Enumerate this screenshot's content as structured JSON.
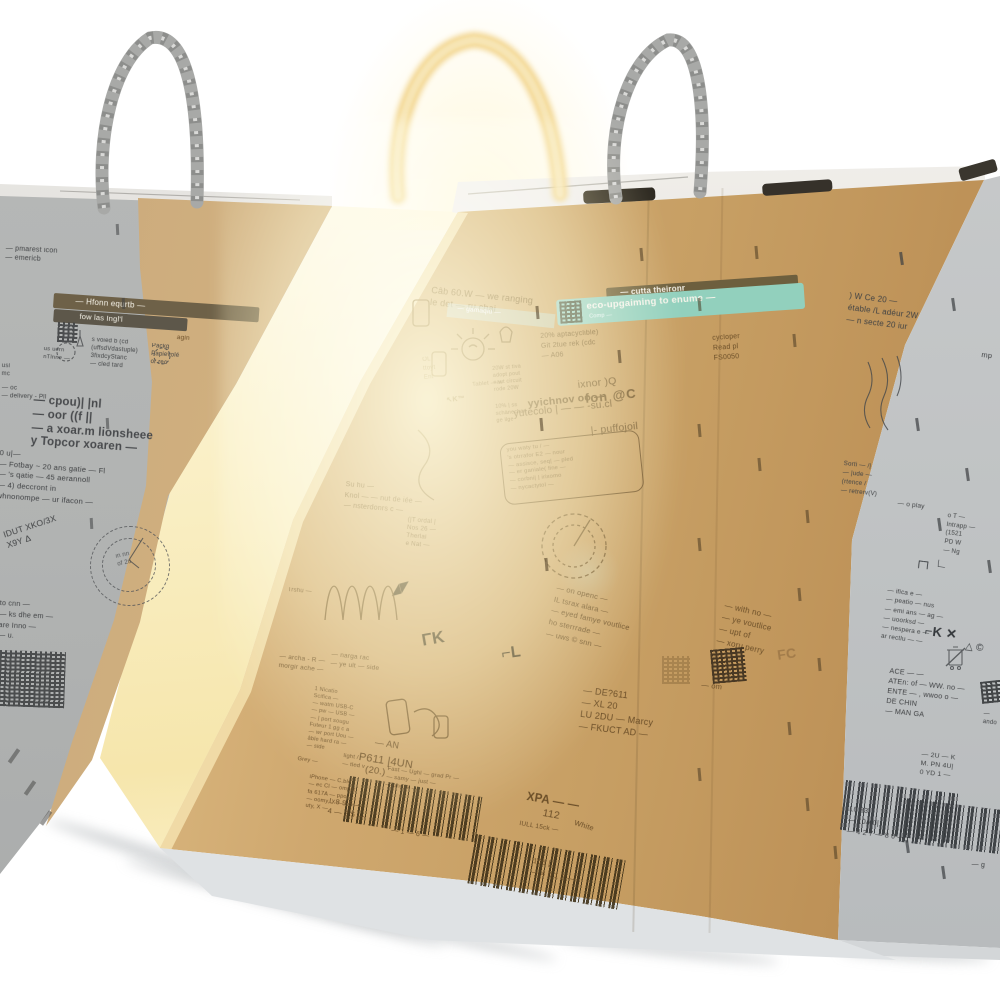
{
  "colors": {
    "kraft_lit": "#cfa86f",
    "kraft_bright": "#ecd6a4",
    "kraft_dark": "#b78a50",
    "shadow_grey": "#b5b7b6",
    "side_grey": "#c0c3c4",
    "print_brown": "#6b4e28",
    "print_grey": "#3f4143",
    "teal_banner": "#92d0bd",
    "olive_banner": "#6d5f3e",
    "glow_yellow": "#f6e6ac",
    "handle_grey": "#a6a7a5",
    "handle_glow": "#f2d48c",
    "slot_dark": "#2d2921"
  },
  "icons": {
    "qr": "qr-code-pattern",
    "barcode": "ean-barcode",
    "weee": "weee-bin-icon",
    "conformity": "ce-conformity-glyphs",
    "bulb": "lamp-doodle",
    "phone": "smartphone-doodle",
    "spring": "coil-doodle",
    "stamp": "round-certification-stamp",
    "handle": "twisted-paper-handle"
  },
  "left_box": {
    "top_fragments": "— pmarest icon\n— emericb",
    "banner_line1": "—  Hfonn  equrtb —",
    "banner_line2": "fow las Ingl'l",
    "side_small": "us uern\nnTlnne —",
    "recycle_row": "s voied b (cd\n(uffsdVdastuple)\n3fixdcyStanc\n— cled tard",
    "recycle_row2": "Packg\nPapievolé\nor rec",
    "recycle_row3": "agin",
    "edge_fragment": "usl\nmc",
    "port_small": "— oc\n— delivery - Pll",
    "brand_block": "— cpou)| |nl\n— oor  ((f  ||\n— a xoar.m lionsheee\ny Topcor xoaren —",
    "warranty_block": "0 u|—\n— Fotbay ~ 20 ans gatie — Fl\n— 's qatie — 45 aerannoll\n— 4) deccront in\nwhnonompe — ur ifacon —",
    "stamp_vertical": "IDUT XKO/3X\nX9Y Δ",
    "stamp_inner": "in nn\nof 2u",
    "lower_fragments": "to cnn —\n— ks dhe em —\nare Inno —\n— u."
  },
  "front_box": {
    "top_note": "Câb 60.W — we ranging\nle det — ru chai",
    "eco_banner_pale": "— gamaqiu —",
    "eco_banner_dark": "— cutta theironr",
    "eco_banner_teal": "eco-upgaiming to enume —",
    "eco_banner_sub": "Comp —",
    "recycle_text": "20% aptacyclible)\nGit 2tue rek (cdc\n— A06",
    "recycle_text2": "cycloper\nRead pl\nFS0050",
    "badge_20w": "20W st tiva\nadopt pout\nnaut circuit\nrode 20W",
    "tablet_label": "Tablet — w",
    "km_label": "↖K™",
    "left_icons_label": "OL\nttoyt\nEnt",
    "schar_label": "10% | ss\nschänechar\nge   ilge",
    "brand_l1": "ixnor )Q",
    "brand_l2": "fon @C",
    "brand_l3": "yyichnov oo —",
    "brand_l4": "yutecolo | — — -su.cl",
    "brand_l5": "|- puffojoil",
    "warranty_block": "you waty tu / —\n's otrrafor E2 — nour\n— assisce, seq| — pled\n— er ganiale( fine —\n— corbni| | irixomo\n— nycactytol —",
    "mid_fragments": "Su hu —\nKnol — — nut de iée —\n— nsterdonrs c —",
    "stamp_text": "(|T ordal |\nNos 26 —\nTherlai\ne Nat —",
    "trshu_label": "Trshu —",
    "glyphs1": "◢◤",
    "glyphs2": "ΓK",
    "glyphs3": "⌐L",
    "right_tilt_block": "— on openc —\nIL tsrax alara —\n— eyed famye voutlice\nho sterrrade —\n— uws © snn —",
    "right_tilt_block2": "— with no —\n— ye voutlice\n— upt of\n— xoru perry",
    "fcc_ghost": "FC",
    "code_block": "— DE?611\n— XL 20\nLU 2DU — Marcy\n— FKUCT AD —",
    "code_om": "— om",
    "specs_block": "1 Nicatio\nScifica —\n— watm USB-C\n— pw — USB —\n— | port sougu\nFuteur 1 gg c a\n— wr port Uou —\nâble hard ra —\n— side",
    "light_label": "light /\n— tled v",
    "fast_block": "Fast — Ughl — grad Pr —\n— samy — just —\n— ung, k —",
    "marga_block": "— narga rac\n— ye ult — side",
    "archa_block": "— archa - R —\nmorgir ache —",
    "ean_label": "— AN",
    "code_p611": "P611 |4UN",
    "code_20": "(20.)",
    "barcode1_left": "L 8 9 5 —\n4 — 2 5 —",
    "barcode1_digits": "— 1 — 6 —",
    "xpa_label": "XPA — —",
    "num_112": "112",
    "black_label": "IULL 15ck —",
    "white_label": "White",
    "barcode2_digits": "105 |\n— 4 0 1 2 —",
    "iphone_block": "iPhone — C.ble\n— ec Cl — ompot\nfa 617A — ppo,\n— oomy, X —\nuty, X —",
    "gray_label": "Grey —"
  },
  "side_face": {
    "top_block": ") W Ce 20 —\nétable /L adéur 2W\n— n secte 20 iur",
    "mp_label": "mp",
    "sorti_block": "Sorti — /|\n— |ude —\n(rtence /\n— retrerv(V)",
    "play_label": "— o play",
    "pd_block": "o T —\nIntrapp —\n(1521\nPD W\n— Ng",
    "glyphs1": "┌┐ ∟",
    "spec_block": "— ifica e —\n— peatio — nus\n— emi ans — ag —\n— uoorksd —\n— nespera e —\nar rectlu — —",
    "glyphs2": "⌐K ✕",
    "glyphs3": "△ ©",
    "made_block": "ACE — —\nATEn: of — WW. no —\nENTE — , wwoo o —\nDE CHIN\n— MAN GA",
    "ando_label": "— ando",
    "barcode_k": "— 2U — K\nM. PN 4U|\n0 YD 1 —",
    "barcode_digits": "L0 33\n— 10A 0|\n— 4 2 7 — 8 0 —",
    "mg_label": "— g"
  }
}
